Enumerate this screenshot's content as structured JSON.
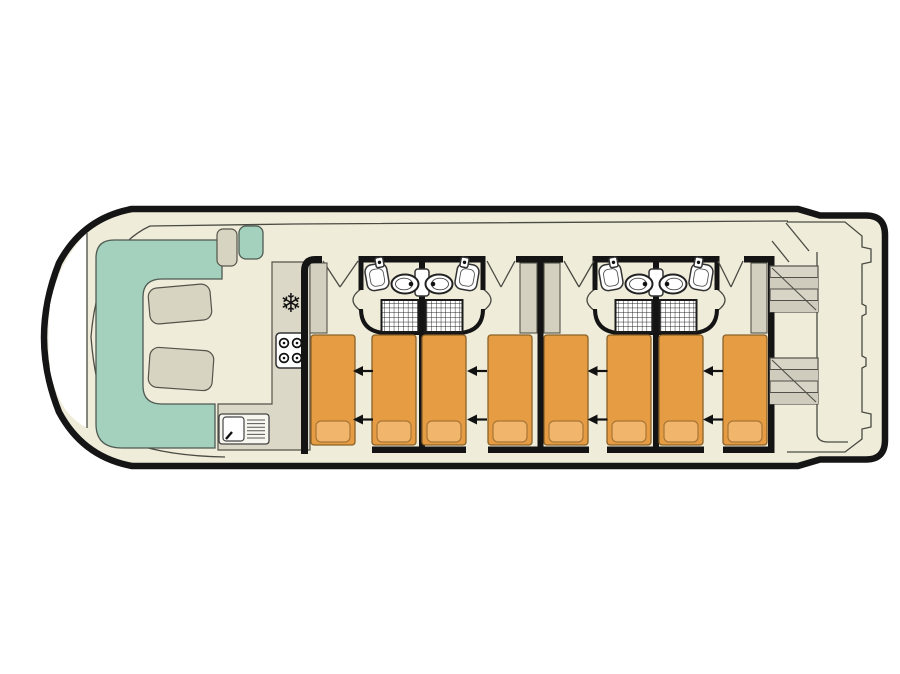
{
  "diagram": {
    "type": "boat-deck-plan",
    "description": "Top-down deck plan of a canal cruiser houseboat",
    "freezer_glyph": "❄"
  },
  "colors": {
    "page_bg": "#ffffff",
    "deck": "#efecda",
    "hull_line": "#151515",
    "thin_line": "#4b4b43",
    "seating_teal": "#a4d1bd",
    "furniture_beige": "#d8d4c2",
    "counter_beige": "#dcd8c7",
    "wardrobe_grey": "#d3d0c0",
    "stair_tread": "#d3d0c1",
    "bed_orange": "#e69c42",
    "pillow_orange": "#f2b56c",
    "fixture_white": "#ffffff",
    "wall_black": "#141414"
  },
  "inventory": {
    "saloon_sofas": 1,
    "saloon_tables": 2,
    "helm_seats": 2,
    "hob_burners": 4,
    "galley_sinks": 1,
    "cabins": 4,
    "single_beds": 8,
    "bed_slide_arrows": 8,
    "bathrooms": 4,
    "washbasins": 4,
    "toilets": 4,
    "showers": 4,
    "wardrobes": 4,
    "stern_staircases": 2
  }
}
